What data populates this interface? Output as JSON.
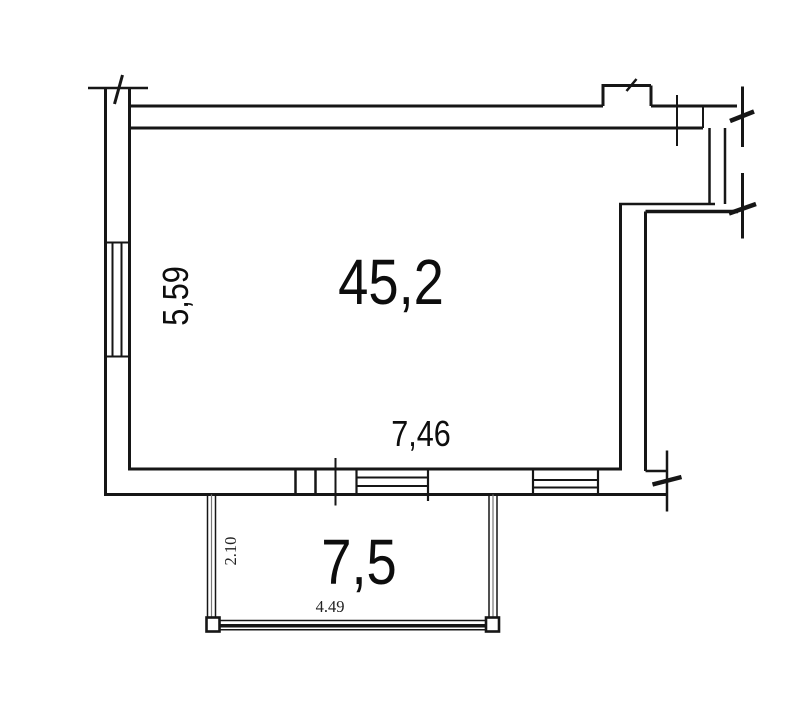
{
  "plan": {
    "main_room": {
      "area": "45,2",
      "width_dim": "7,46",
      "depth_dim": "5,59"
    },
    "balcony": {
      "area": "7,5",
      "width_dim": "4.49",
      "depth_dim": "2.10"
    }
  },
  "colors": {
    "line": "#161616",
    "background": "#ffffff",
    "glazing_middle": "#777777"
  }
}
